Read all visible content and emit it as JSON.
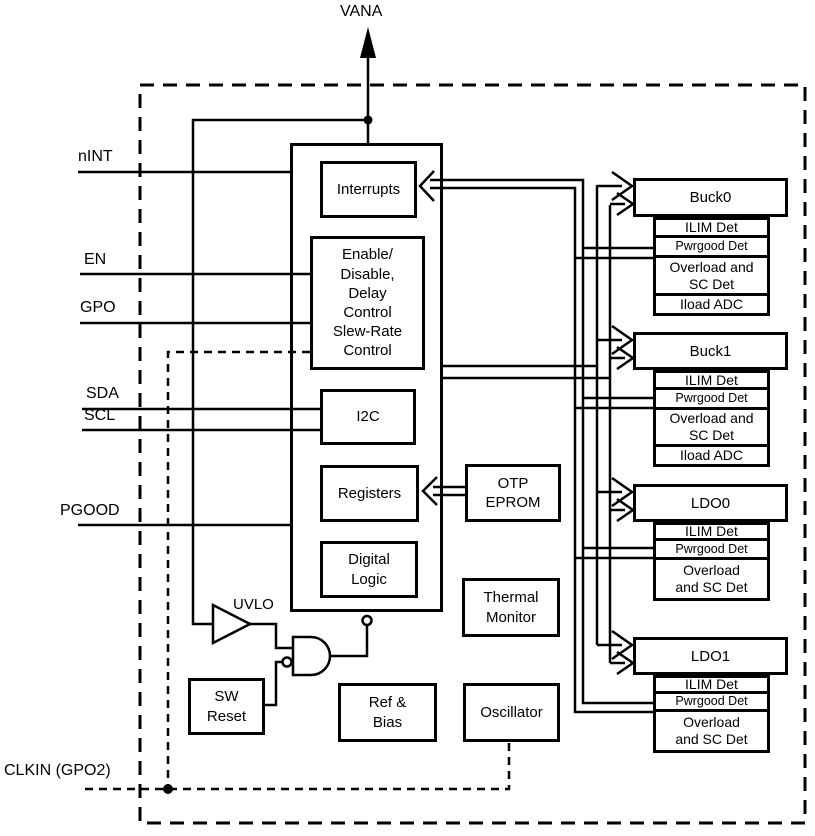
{
  "colors": {
    "line": "#000000",
    "background": "#ffffff"
  },
  "pins": {
    "vana": "VANA",
    "nint": "nINT",
    "en": "EN",
    "gpo": "GPO",
    "sda": "SDA",
    "scl": "SCL",
    "pgood": "PGOOD",
    "clkin": "CLKIN (GPO2)"
  },
  "core_blocks": {
    "interrupts": "Interrupts",
    "enable": "Enable/\nDisable,\nDelay\nControl\nSlew-Rate\nControl",
    "i2c": "I2C",
    "registers": "Registers",
    "digital_logic": "Digital\nLogic",
    "uvlo": "UVLO",
    "sw_reset": "SW\nReset"
  },
  "support_blocks": {
    "otp_eprom": "OTP\nEPROM",
    "thermal_monitor": "Thermal\nMonitor",
    "ref_bias": "Ref &\nBias",
    "oscillator": "Oscillator"
  },
  "power_blocks": [
    {
      "name": "Buck0",
      "rows": [
        "ILIM Det",
        "Pwrgood Det",
        "Overload and\nSC Det",
        "Iload ADC"
      ]
    },
    {
      "name": "Buck1",
      "rows": [
        "ILIM Det",
        "Pwrgood Det",
        "Overload and\nSC Det",
        "Iload ADC"
      ]
    },
    {
      "name": "LDO0",
      "rows": [
        "ILIM Det",
        "Pwrgood Det",
        "Overload\nand SC Det"
      ]
    },
    {
      "name": "LDO1",
      "rows": [
        "ILIM Det",
        "Pwrgood Det",
        "Overload\nand SC Det"
      ]
    }
  ]
}
